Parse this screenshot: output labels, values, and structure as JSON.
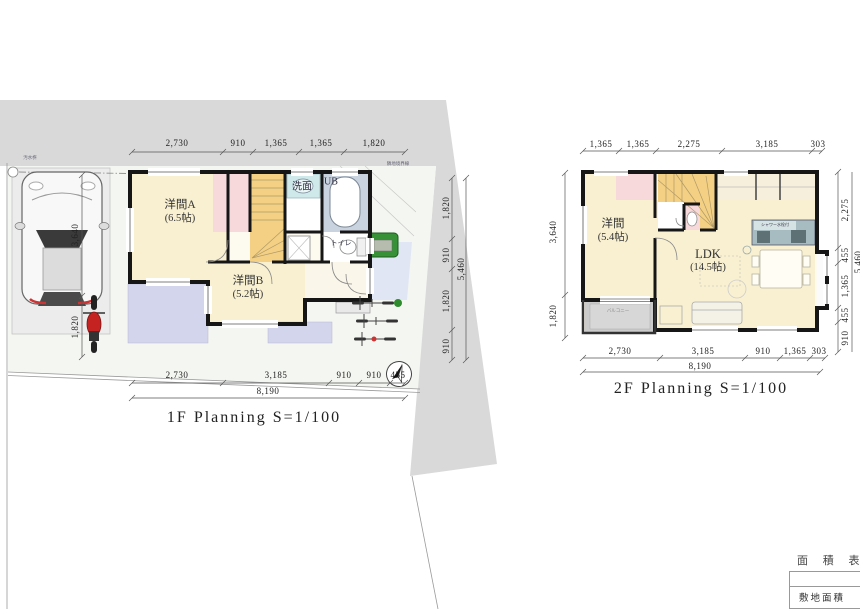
{
  "colors": {
    "road": "#d9d9d9",
    "yard": "#f4f6f1",
    "cream": "#f9f0d2",
    "orange": "#f3d083",
    "pink": "#f7d9dc",
    "lavender": "#d3d5ec",
    "porch": "#dde3f5",
    "bath": "#c9d3df",
    "vanity": "#cfe9ea",
    "kitchen": "#a7bcc0",
    "balcony": "#cbcbcb",
    "green": "#379237",
    "red": "#c52222"
  },
  "f1": {
    "title": "1F Planning S=1/100",
    "dims_top": [
      "2,730",
      "910",
      "1,365",
      "1,365",
      "1,820"
    ],
    "dims_bottom": [
      "2,730",
      "3,185",
      "910",
      "910",
      "455"
    ],
    "total_w": "8,190",
    "dims_right": [
      "1,820",
      "910",
      "1,820",
      "910"
    ],
    "total_h": "5,460",
    "dims_left": [
      "3,640",
      "1,820"
    ],
    "rooms": {
      "room_a": {
        "name": "洋間A",
        "size": "(6.5帖)"
      },
      "room_b": {
        "name": "洋間B",
        "size": "(5.2帖)"
      },
      "washroom": "洗面",
      "bath": "UB",
      "toilet": "トイレ"
    },
    "site": {
      "manhole_label": "汚水桝",
      "boundary_label": "隣地境界線"
    }
  },
  "f2": {
    "title": "2F Planning S=1/100",
    "dims_top": [
      "1,365",
      "1,365",
      "2,275",
      "3,185",
      "303"
    ],
    "dims_bottom": [
      "2,730",
      "3,185",
      "910",
      "1,365",
      "303"
    ],
    "total_w": "8,190",
    "dims_right": [
      "2,275",
      "455",
      "1,365",
      "455",
      "910"
    ],
    "total_h": "5,460",
    "dims_left": [
      "3,640",
      "1,820"
    ],
    "rooms": {
      "room": {
        "name": "洋間",
        "size": "(5.4帖)"
      },
      "ldk": {
        "name": "LDK",
        "size": "(14.5帖)"
      },
      "balcony": "バルコニー",
      "kitchen_note": "シャワー水栓付"
    }
  },
  "area_table": {
    "heading": "面 積 表",
    "row1": "敷地面積"
  }
}
